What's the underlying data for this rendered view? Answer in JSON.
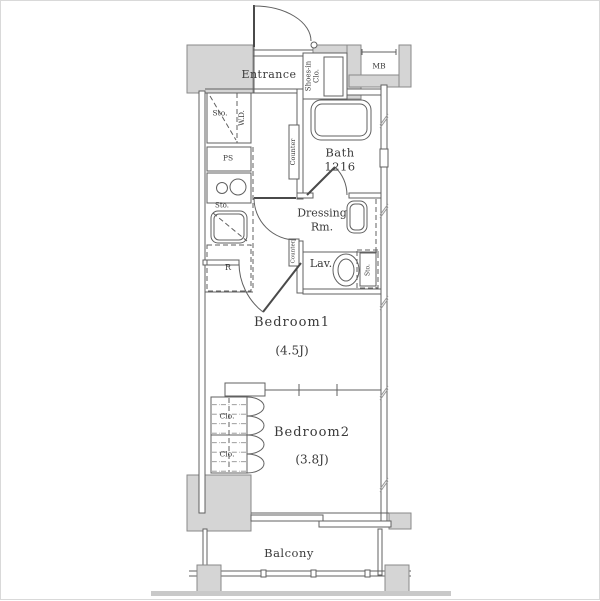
{
  "colors": {
    "bg": "#ffffff",
    "border": "#d9d9d9",
    "wall_fill": "#d5d5d5",
    "wall_stroke": "#898989",
    "line": "#606060",
    "strip": "#c9c9c9",
    "text": "#3a3a3a"
  },
  "rooms": {
    "entrance": {
      "label": "Entrance"
    },
    "shoes_in_closet": {
      "line1": "Shoes-in",
      "line2": "Clo."
    },
    "meter_box": {
      "label": "MB"
    },
    "hall_storage": {
      "label": "Sto."
    },
    "washer_dryer": {
      "label": "W.D."
    },
    "pipe_space": {
      "label": "PS"
    },
    "kitchen_storage": {
      "label": "Sto."
    },
    "refrigerator": {
      "label": "R"
    },
    "counter_upper": {
      "label": "Counter"
    },
    "counter_lower": {
      "label": "Counter"
    },
    "bath": {
      "label": "Bath",
      "size": "1216"
    },
    "dressing_room": {
      "line1": "Dressing",
      "line2": "Rm."
    },
    "lavatory": {
      "label": "Lav."
    },
    "lavatory_storage": {
      "label": "Sto."
    },
    "bedroom1": {
      "label": "Bedroom1",
      "size": "(4.5J)"
    },
    "bedroom2": {
      "label": "Bedroom2",
      "size": "(3.8J)"
    },
    "closet_upper": {
      "label": "Clo."
    },
    "closet_lower": {
      "label": "Clo."
    },
    "balcony": {
      "label": "Balcony"
    }
  }
}
